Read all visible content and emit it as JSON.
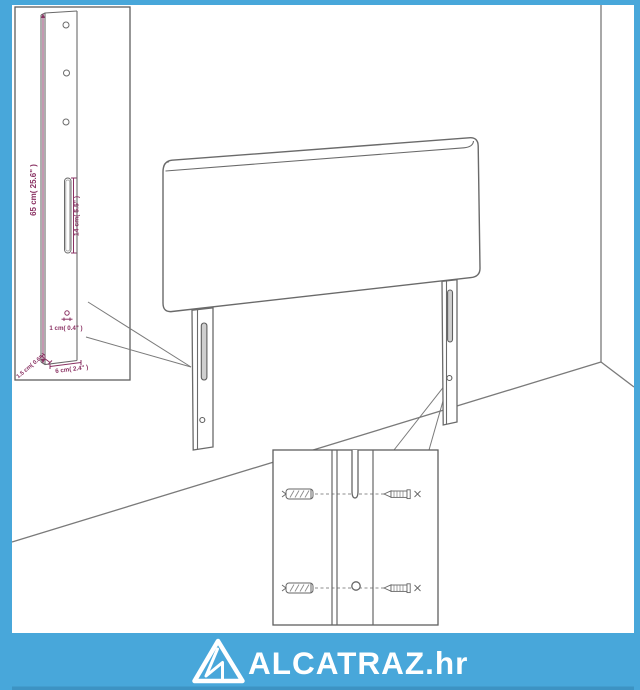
{
  "colors": {
    "accent_blue": "#48A7DA",
    "accent_blue_dark": "#3D93C3",
    "line_gray": "#6A6A6A",
    "dimension_plum": "#8A3263",
    "background": "#FFFFFF",
    "logo_white": "#FFFFFF",
    "slot_fill": "#CFCFCF"
  },
  "footer": {
    "logo_text": "ALCATRAZ.hr",
    "logo_icon": "alcatraz-triangle-icon"
  },
  "leg_detail_inset": {
    "dimensions": {
      "height": "65 cm( 25.6\" )",
      "slot": "14 cm( 5.5\" )",
      "hole": "1 cm( 0.4\" )",
      "thickness": "1.5 cm( 0.6\" )",
      "width": "6 cm( 2.4\" )"
    },
    "icons": [
      "screw-hole-icon",
      "mounting-slot-icon"
    ]
  },
  "hardware_inset": {
    "icons": [
      "wall-plug-icon",
      "screw-icon",
      "screw-hole-icon",
      "mounting-slot-icon"
    ]
  }
}
